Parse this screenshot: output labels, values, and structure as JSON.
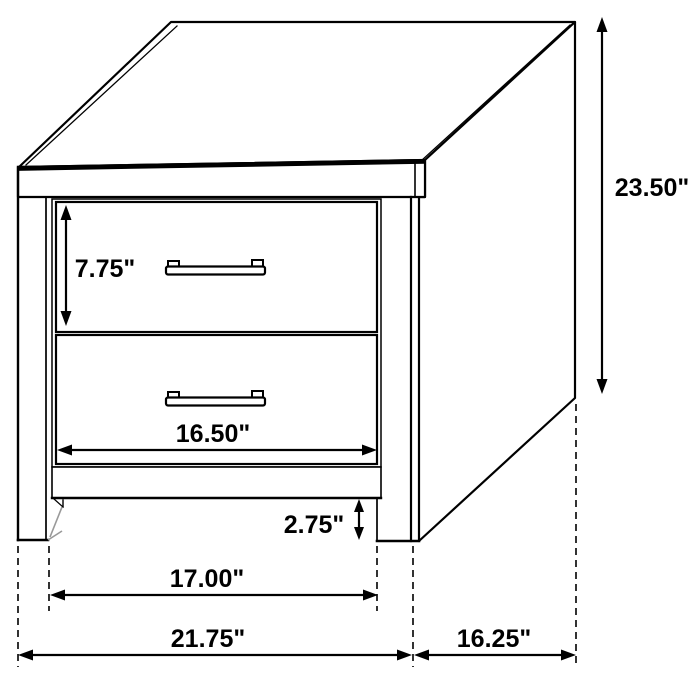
{
  "diagram": {
    "subject": "nightstand",
    "description": "Line drawing of a two-drawer nightstand with dimension arrows",
    "background_color": "#ffffff",
    "line_color": "#000000",
    "shadow_color": "#999999",
    "units": "inches",
    "labels": {
      "overall_height": "23.50\"",
      "top_drawer_height": "7.75\"",
      "drawer_width": "16.50\"",
      "base_clearance": "2.75\"",
      "inner_leg_width": "17.00\"",
      "overall_width": "21.75\"",
      "overall_depth": "16.25\""
    }
  }
}
